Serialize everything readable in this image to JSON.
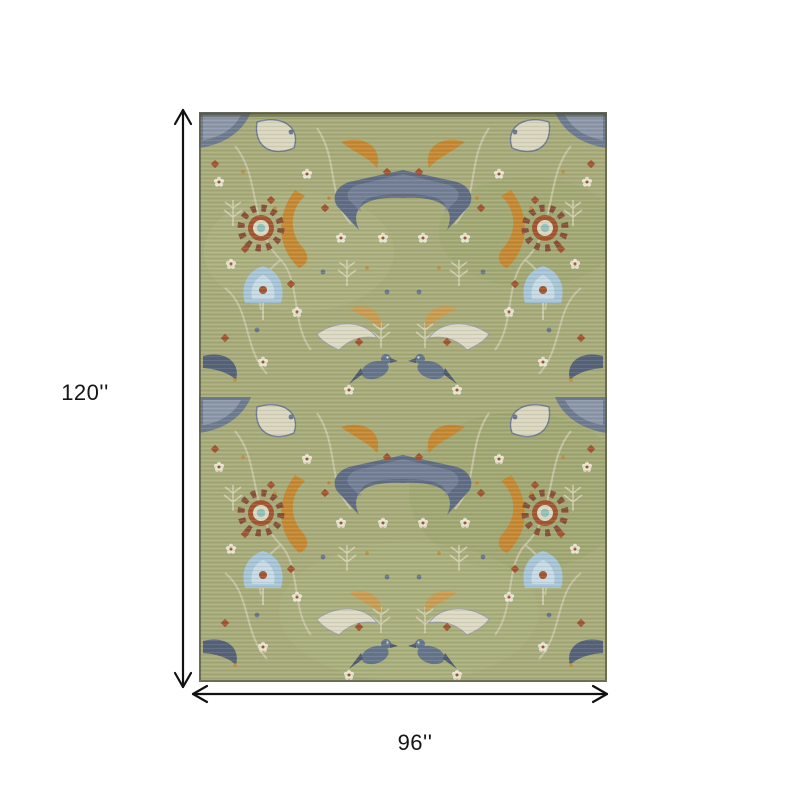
{
  "diagram": {
    "type": "product-dimension-diagram",
    "product": "sage green oriental floral area rug",
    "height_label": "120''",
    "width_label": "96''"
  },
  "arrows": {
    "color": "#111111"
  },
  "rug": {
    "description": "Distressed sage green Oushak-style rug with symmetric floral vines, bird motifs, palmettes and medallions in cream, light blue, slate blue, orange, rust and brown",
    "colors": {
      "base_green": "#a7ac78",
      "base_green_light": "#b4b887",
      "base_green_dark": "#99a067",
      "cream": "#d5d1b8",
      "ivory": "#e8e4d2",
      "light_blue": "#a6c6dc",
      "pale_blue": "#c6dbe9",
      "slate_blue": "#68758e",
      "dark_slate": "#55617a",
      "orange": "#c8882f",
      "rust": "#a5542e",
      "brown": "#8a4f35",
      "teal": "#8fc3bd",
      "edge": "#5e5e46"
    }
  }
}
